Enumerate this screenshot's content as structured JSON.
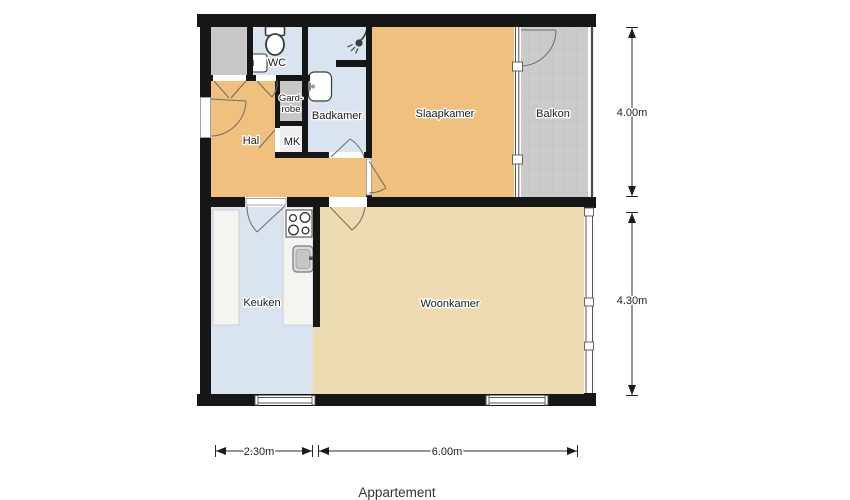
{
  "title": "Appartement",
  "rooms": {
    "hal": {
      "label": "Hal"
    },
    "wc": {
      "label": "WC"
    },
    "garderobe": {
      "label_line1": "Gard-",
      "label_line2": "robe"
    },
    "mk": {
      "label": "MK"
    },
    "badkamer": {
      "label": "Badkamer"
    },
    "slaapkamer": {
      "label": "Slaapkamer"
    },
    "balkon": {
      "label": "Balkon"
    },
    "keuken": {
      "label": "Keuken"
    },
    "woonkamer": {
      "label": "Woonkamer"
    }
  },
  "dimensions": {
    "right_top": "4.00m",
    "right_bottom": "4.30m",
    "bottom_left": "2.30m",
    "bottom_right": "6.00m"
  },
  "icons": {
    "toilet": "toilet-icon",
    "wc_sink": "wc-sink-icon",
    "bathroom_sink": "bathroom-sink-icon",
    "shower": "shower-icon",
    "stove": "stove-icon",
    "kitchen_sink": "kitchen-sink-icon"
  },
  "colors": {
    "wall": "#161616",
    "hal": "#f0c07e",
    "slaapkamer": "#f0c07e",
    "woonkamer": "#eedbb2",
    "wet_room_blue": "#d9e4f0",
    "balkon_gray": "#cbcbcb",
    "closet_gray": "#c7c7c7",
    "mk_floor": "#efefef",
    "counter": "#f5f4f0"
  }
}
